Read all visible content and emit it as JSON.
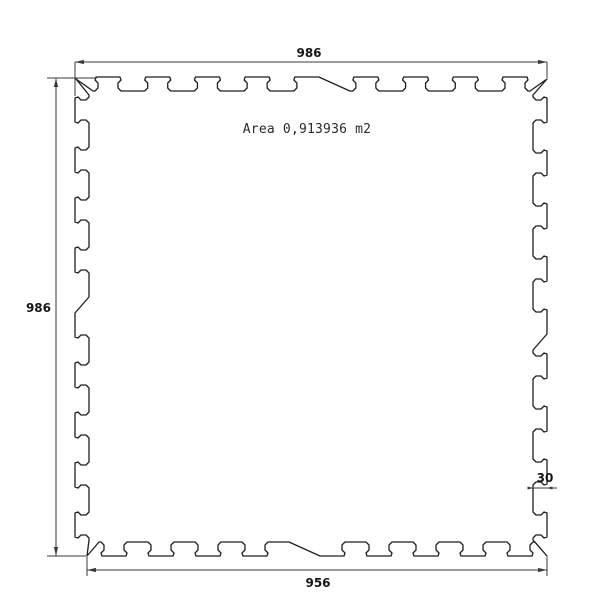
{
  "drawing": {
    "area_label": "Area 0,913936 m2",
    "dimensions": {
      "top_width": "986",
      "left_height": "986",
      "bottom_width": "956",
      "interlock_depth": "30"
    },
    "colors": {
      "background": "#ffffff",
      "outline": "#1f1f1f",
      "dimension": "#3a3a3a"
    }
  }
}
